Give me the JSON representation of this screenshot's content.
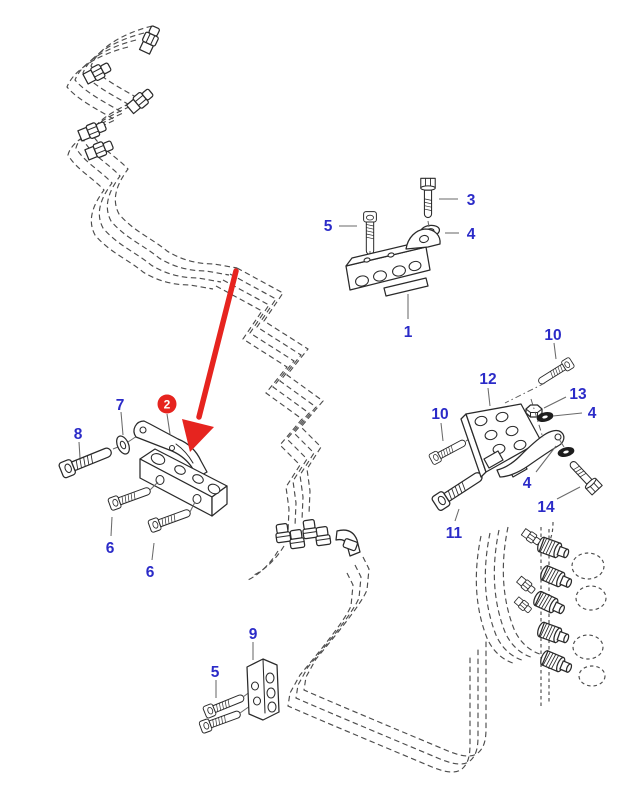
{
  "diagram": {
    "type": "exploded-parts-diagram",
    "description_visible_text_only": true,
    "colors": {
      "background": "#ffffff",
      "line": "#2a2a2a",
      "pipe_dashed": "#4c4c4c",
      "callout": "#2b2bc8",
      "highlight": "#e6241f",
      "highlight_text": "#ffffff"
    },
    "callouts": {
      "k1": "1",
      "k2": "2",
      "k3": "3",
      "k4a": "4",
      "k4b": "4",
      "k4c": "4",
      "k5a": "5",
      "k5b": "5",
      "k6a": "6",
      "k6b": "6",
      "k7": "7",
      "k8": "8",
      "k9": "9",
      "k10a": "10",
      "k10b": "10",
      "k11": "11",
      "k12": "12",
      "k13": "13",
      "k14": "14"
    },
    "highlight": {
      "label": "2",
      "shape": "red-circle-with-arrow"
    },
    "glyphs": [
      "injection-pipe-dashed",
      "pipe-union-fitting",
      "elbow-fitting",
      "bracket",
      "clamp-bar",
      "clamp-block",
      "strap-link",
      "socket-head-screw",
      "hex-bolt",
      "washer",
      "nut",
      "injector-fitting"
    ]
  }
}
